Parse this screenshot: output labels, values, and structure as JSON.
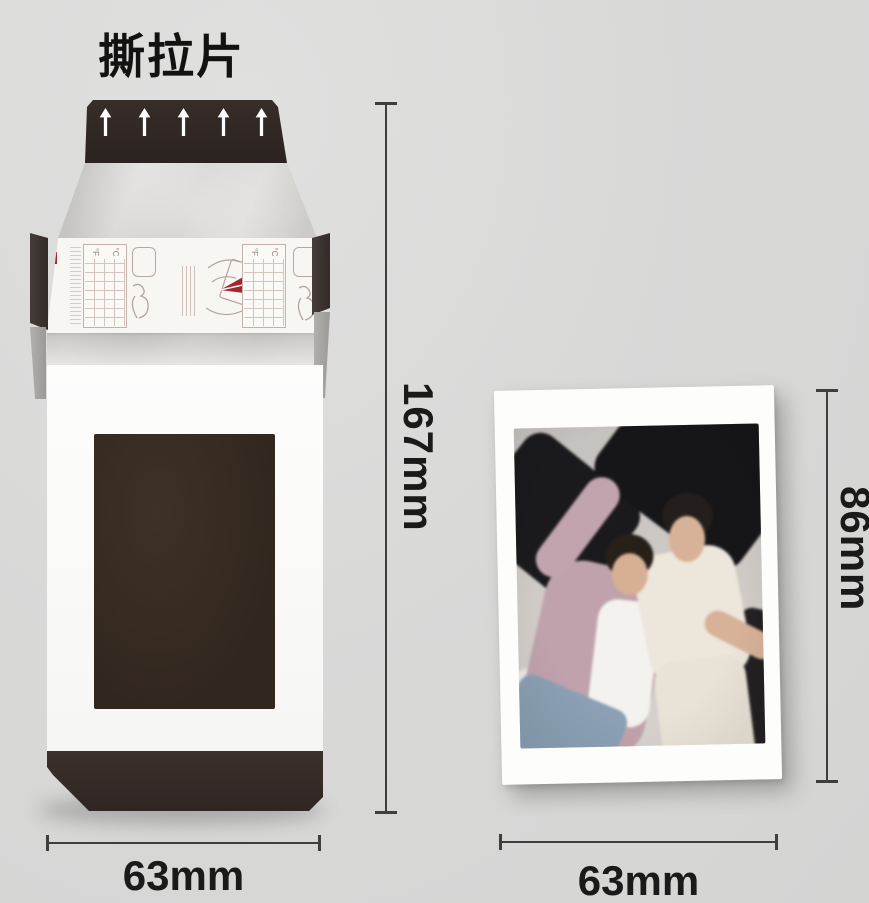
{
  "title": "撕拉片",
  "palette": {
    "background": "#d8d8d8",
    "pack_dark_band": "#2f2724",
    "pack_bottom_band": "#342a26",
    "film_window": "#35291f",
    "pack_paper": "#d5d4d1",
    "instruction_red": "#a32531",
    "dimension_line": "#3e3e3e",
    "dimension_text": "#1a1a1a",
    "photo_border": "#fdfdfc"
  },
  "film_pack": {
    "arrow_count": 5,
    "height_label": "167mm",
    "width_label": "63mm",
    "instruction_strip": {
      "temp_c": "°C",
      "temp_f": "°F"
    }
  },
  "photo": {
    "height_label": "86mm",
    "width_label": "63mm"
  }
}
